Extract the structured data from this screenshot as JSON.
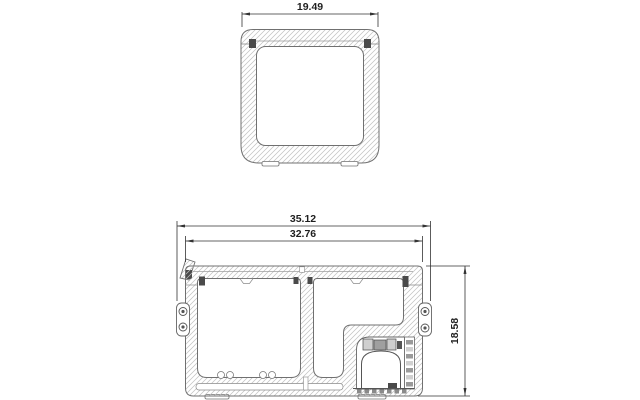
{
  "canvas": {
    "background": "#ffffff",
    "description": "CAD-style cross-section technical drawing of a portable compressor cooler, two views with dimensions"
  },
  "colors": {
    "outline": "#707070",
    "hatch": "#c0c0c0",
    "detail_dark": "#4a4a4a",
    "dimension_line": "#333333",
    "dimension_text": "#1f1f1f"
  },
  "top_view": {
    "name": "top section view",
    "dimensions": {
      "width": "19.49"
    }
  },
  "front_view": {
    "name": "front section view",
    "dimensions": {
      "outer_width": "35.12",
      "inner_width": "32.76",
      "height": "18.58"
    }
  }
}
